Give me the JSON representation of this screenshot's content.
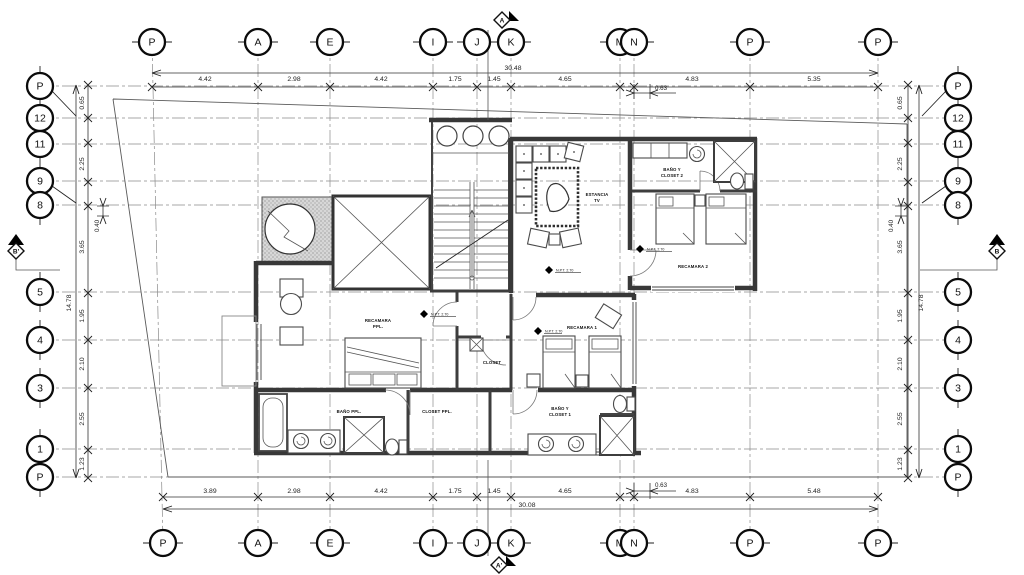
{
  "grid": {
    "columns": [
      "P",
      "A",
      "E",
      "I",
      "J",
      "K",
      "M",
      "N",
      "P",
      "P"
    ],
    "rows": [
      "P",
      "12",
      "11",
      "9",
      "8",
      "5",
      "4",
      "3",
      "1",
      "P"
    ]
  },
  "dimensions": {
    "top": {
      "segments": [
        "4.42",
        "2.98",
        "4.42",
        "1.75",
        "1.45",
        "4.65",
        "4.83",
        "5.35"
      ],
      "total": "30.48",
      "sub": "0.63"
    },
    "bottom": {
      "segments": [
        "3.89",
        "2.98",
        "4.42",
        "1.75",
        "1.45",
        "4.65",
        "4.83",
        "5.48"
      ],
      "total": "30.08",
      "sub": "0.63"
    },
    "left": {
      "segments": [
        "0.65",
        "2.25",
        "3.65",
        "1.95",
        "2.10",
        "2.55",
        "1.23"
      ],
      "total": "14.78",
      "sub": "0.40"
    },
    "right": {
      "segments": [
        "0.65",
        "2.25",
        "3.65",
        "1.95",
        "2.10",
        "2.55",
        "1.23"
      ],
      "total": "14.78",
      "sub": "0.40"
    }
  },
  "rooms": {
    "estancia": [
      "ESTANCIA",
      "TV"
    ],
    "recamara2": [
      "RECAMARA 2"
    ],
    "banoCloset2": [
      "BAÑO Y",
      "CLOSET 2"
    ],
    "recamaraPpl": [
      "RECAMARA",
      "PPL."
    ],
    "banoPpl": [
      "BAÑO PPL."
    ],
    "closetPpl": [
      "CLOSET PPL."
    ],
    "closet": [
      "CLOSET"
    ],
    "recamara1": [
      "RECAMARA 1"
    ],
    "banoCloset1": [
      "BAÑO Y",
      "CLOSET 1"
    ]
  },
  "levels": {
    "npt": "N.P.T. 2.70"
  },
  "sections": {
    "top": "A",
    "bottom": "A'",
    "left": "B'",
    "right": "B"
  }
}
